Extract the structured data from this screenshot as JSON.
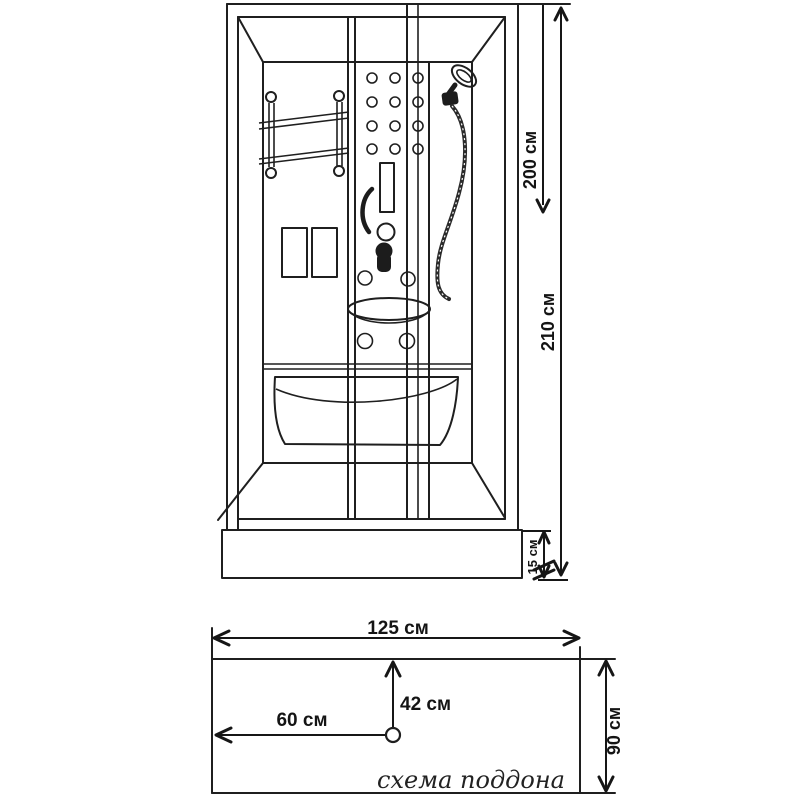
{
  "colors": {
    "line": "#1f1f1f",
    "background": "#ffffff",
    "text": "#141414"
  },
  "dimensions": {
    "front": {
      "glass_height": "200 см",
      "total_height": "210 см",
      "tray_height": "15 см"
    },
    "tray": {
      "width": "125 см",
      "depth": "90 см",
      "drain_from_top": "42 см",
      "drain_from_left": "60 см"
    }
  },
  "captions": {
    "tray_schematic": "схема поддона"
  }
}
